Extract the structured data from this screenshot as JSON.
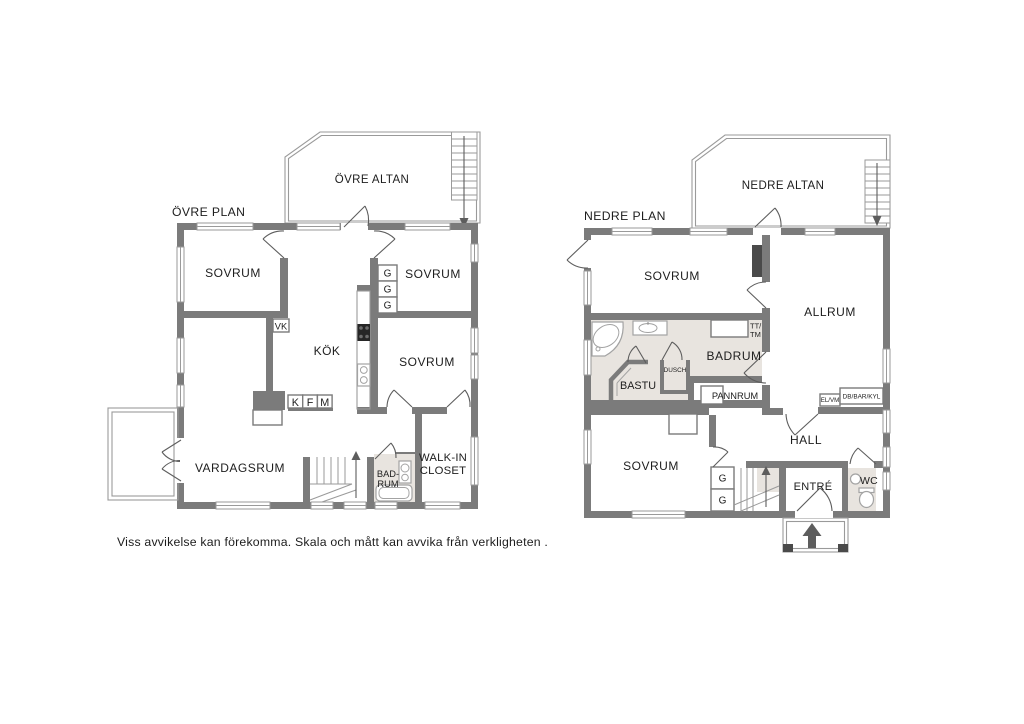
{
  "colors": {
    "wall": "#7b7b7b",
    "bathfloor": "#e8e4df",
    "text": "#1d1d1d",
    "thin": "#9a9a9a",
    "door": "#5d5d5d",
    "fixture": "#a3a3a3",
    "stove": "#262626",
    "post": "#4a4a4a"
  },
  "upper": {
    "title": "ÖVRE PLAN",
    "balcony": "ÖVRE ALTAN",
    "bedroom_nw": "SOVRUM",
    "bedroom_ne": "SOVRUM",
    "bedroom_e": "SOVRUM",
    "kitchen": "KÖK",
    "living": "VARDAGSRUM",
    "bath1": "BAD-",
    "bath2": "RUM",
    "wic1": "WALK-IN",
    "wic2": "CLOSET",
    "vk": "VK",
    "g1": "G",
    "g2": "G",
    "g3": "G",
    "k": "K",
    "f": "F",
    "m": "M"
  },
  "lower": {
    "title": "NEDRE PLAN",
    "balcony": "NEDRE ALTAN",
    "bedroom_n": "SOVRUM",
    "bedroom_s": "SOVRUM",
    "allrum": "ALLRUM",
    "badrum": "BADRUM",
    "bastu": "BASTU",
    "dusch": "DUSCH",
    "pannrum": "PANNRUM",
    "hall": "HALL",
    "entre": "ENTRÉ",
    "wc": "WC",
    "tt1": "TT/",
    "tt2": "TM",
    "elvm": "EL/VM",
    "db": "DB/BAR/KYL",
    "g1": "G",
    "g2": "G"
  },
  "footer": {
    "disclaimer": "Viss avvikelse kan förekomma. Skala och mått kan avvika från verkligheten ."
  }
}
